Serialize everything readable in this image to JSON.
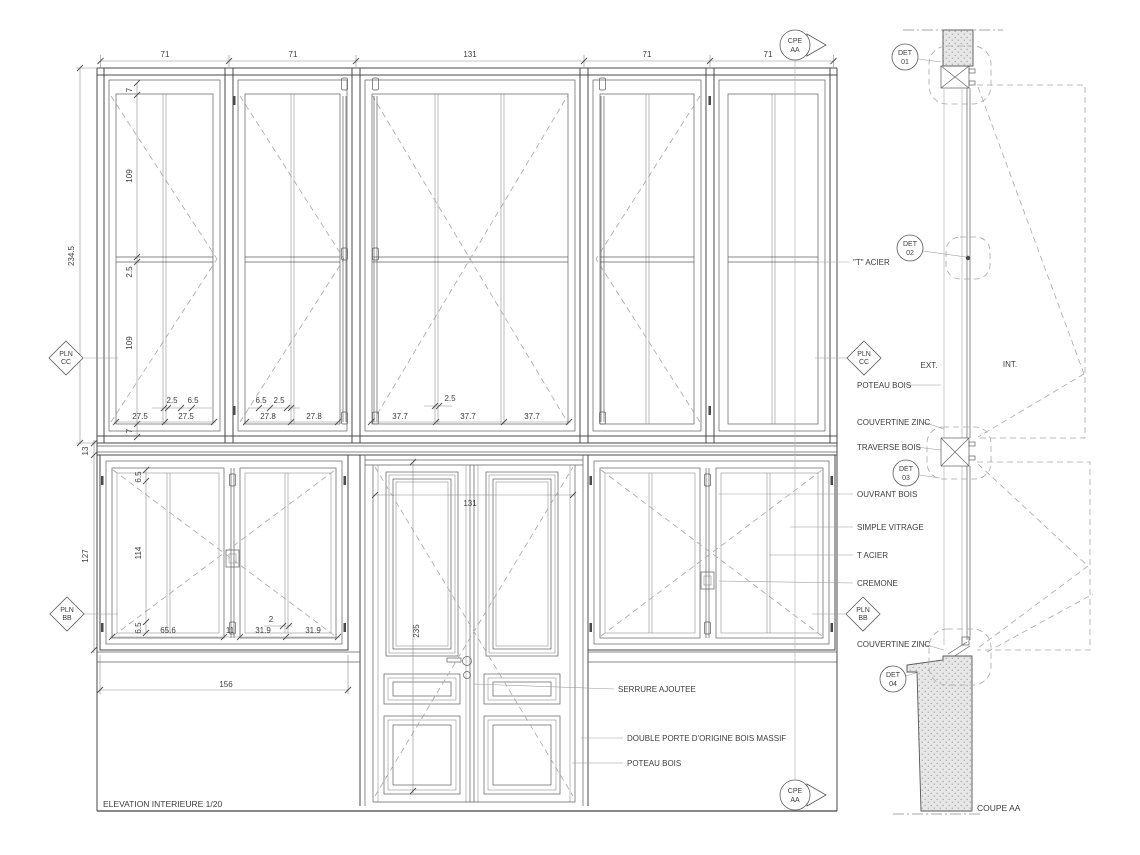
{
  "titles": {
    "elevation": "ELEVATION INTERIEURE  1/20",
    "section": "COUPE  AA"
  },
  "zones": {
    "ext": "EXT.",
    "int": "INT."
  },
  "dims": {
    "top": [
      "71",
      "71",
      "131",
      "71",
      "71"
    ],
    "upper_left_chain": [
      "234.5",
      "7",
      "109",
      "2.5",
      "109",
      "7"
    ],
    "mid_left_chain": [
      "13",
      "127"
    ],
    "lower_left_chain": [
      "6.5",
      "114",
      "6.5"
    ],
    "band_bay1": [
      "2.5",
      "6.5",
      "27.5",
      "27.5"
    ],
    "band_bay2": [
      "6.5",
      "2.5",
      "27.8",
      "27.8"
    ],
    "band_bay3": [
      "2.5",
      "37.7",
      "37.7",
      "37.7"
    ],
    "lower_window": [
      "65.6",
      "11",
      "2",
      "31.9",
      "31.9"
    ],
    "plinth": [
      "156"
    ],
    "door": [
      "131",
      "235"
    ]
  },
  "annotations": {
    "t_acier_top": "\"T\" ACIER",
    "poteau_bois": "POTEAU BOIS",
    "couvertine_zinc": "COUVERTINE ZINC",
    "traverse_bois": "TRAVERSE BOIS",
    "ouvrant_bois": "OUVRANT BOIS",
    "simple_vitrage": "SIMPLE VITRAGE",
    "t_acier": "T ACIER",
    "cremone": "CREMONE",
    "couvertine_zinc2": "COUVERTINE ZINC",
    "serrure": "SERRURE AJOUTEE",
    "double_porte": "DOUBLE PORTE D'ORIGINE BOIS MASSIF",
    "poteau_bois2": "POTEAU BOIS"
  },
  "markers": {
    "pln_cc": [
      "PLN",
      "CC"
    ],
    "pln_bb": [
      "PLN",
      "BB"
    ],
    "cpe_aa": [
      "CPE",
      "AA"
    ],
    "det01": [
      "DET",
      "01"
    ],
    "det02": [
      "DET",
      "02"
    ],
    "det03": [
      "DET",
      "03"
    ],
    "det04": [
      "DET",
      "04"
    ]
  },
  "colors": {
    "drawing_line": "#4a4a4a",
    "light_line": "#b5b5b5",
    "dashed_line": "#a8a8a8",
    "wall_fill": "#e7e7e7",
    "stipple_dot": "#a5a5a5",
    "text": "#3d3d3d",
    "background": "#ffffff"
  }
}
